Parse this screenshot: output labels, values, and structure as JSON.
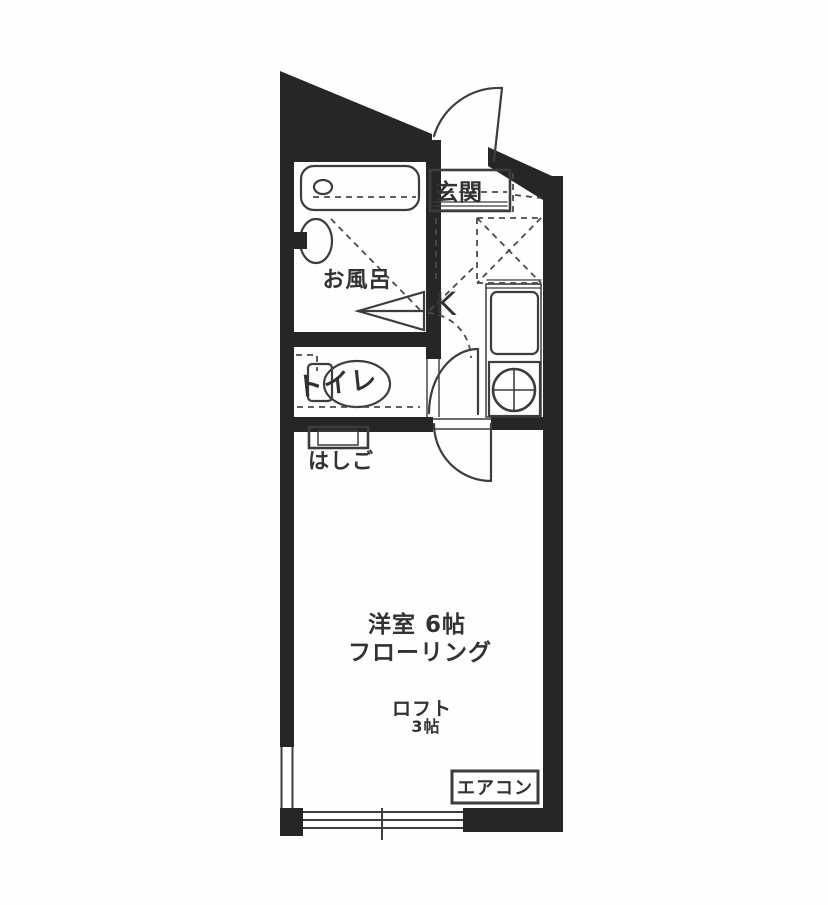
{
  "plan": {
    "wall_color": "#262626",
    "line_color": "#3d3d3d",
    "dash_color": "#4a4a4a",
    "text_color": "#323232",
    "bg_color": "#fffefd",
    "rooms": {
      "entrance_label": "玄関",
      "bath_label": "お風呂",
      "kitchen_label": "K",
      "toilet_label": "トイレ",
      "ladder_label": "はしご",
      "main_room_label": "洋室 6帖",
      "flooring_label": "フローリング",
      "loft_label": "ロフト",
      "loft_size_label": "3帖",
      "aircon_label": "エアコン"
    }
  }
}
